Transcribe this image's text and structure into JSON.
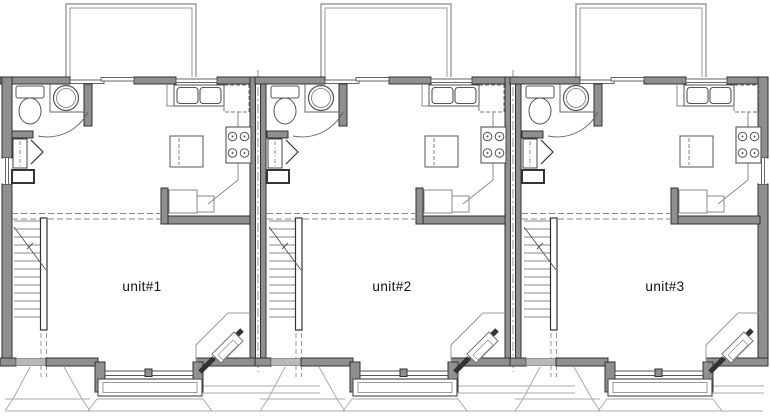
{
  "canvas": {
    "width": 770,
    "height": 416,
    "background": "#ffffff"
  },
  "plan": {
    "type": "triplex-floor-plan",
    "units": [
      {
        "id": "unit-1",
        "label": "unit#1",
        "label_x": 142,
        "label_y": 291,
        "offset_x": 0
      },
      {
        "id": "unit-2",
        "label": "unit#2",
        "label_x": 392,
        "label_y": 291,
        "offset_x": 255
      },
      {
        "id": "unit-3",
        "label": "unit#3",
        "label_x": 665,
        "label_y": 291,
        "offset_x": 510
      }
    ],
    "fixtures_per_unit": [
      "deck",
      "rear-sliding-door",
      "bathroom",
      "toilet",
      "round-sink",
      "closet",
      "staircase",
      "kitchen-sink",
      "refrigerator",
      "stove",
      "kitchen-island",
      "desk",
      "half-wall",
      "corner-fireplace",
      "bay-window",
      "window-seat",
      "entry-door",
      "porch-steps"
    ]
  },
  "colors": {
    "wall": "#8f8f8f",
    "wall_edge": "#303030",
    "fixture": "#555555",
    "counter": "#8a8a8a",
    "light_line": "#aaaaaa",
    "deck_line": "#9a9a9a",
    "dashed": "#888888",
    "centerline": "#777777",
    "door": "#b8b8b8",
    "label_text": "#111111",
    "background": "#ffffff"
  }
}
